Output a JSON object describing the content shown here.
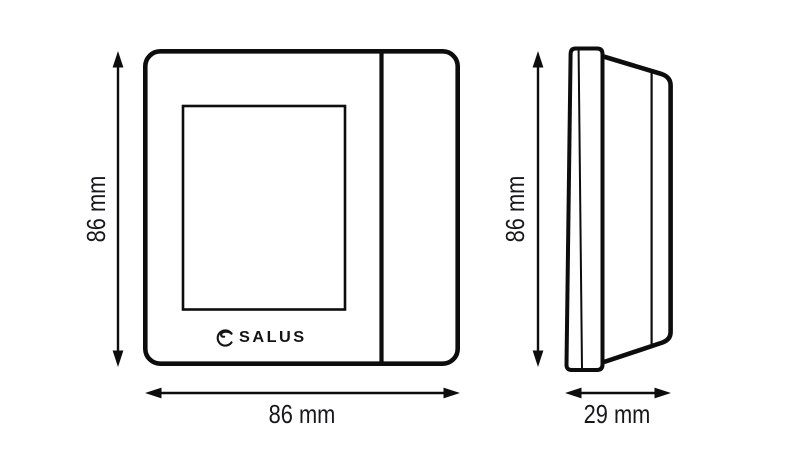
{
  "colors": {
    "line": "#0d0d0d",
    "text": "#17171c",
    "background": "#ffffff"
  },
  "front_view": {
    "height_dimension": "86 mm",
    "width_dimension": "86 mm",
    "logo": {
      "icon": "salus-swirl-icon",
      "text": "SALUS"
    }
  },
  "side_view": {
    "height_dimension": "86 mm",
    "depth_dimension": "29 mm"
  }
}
